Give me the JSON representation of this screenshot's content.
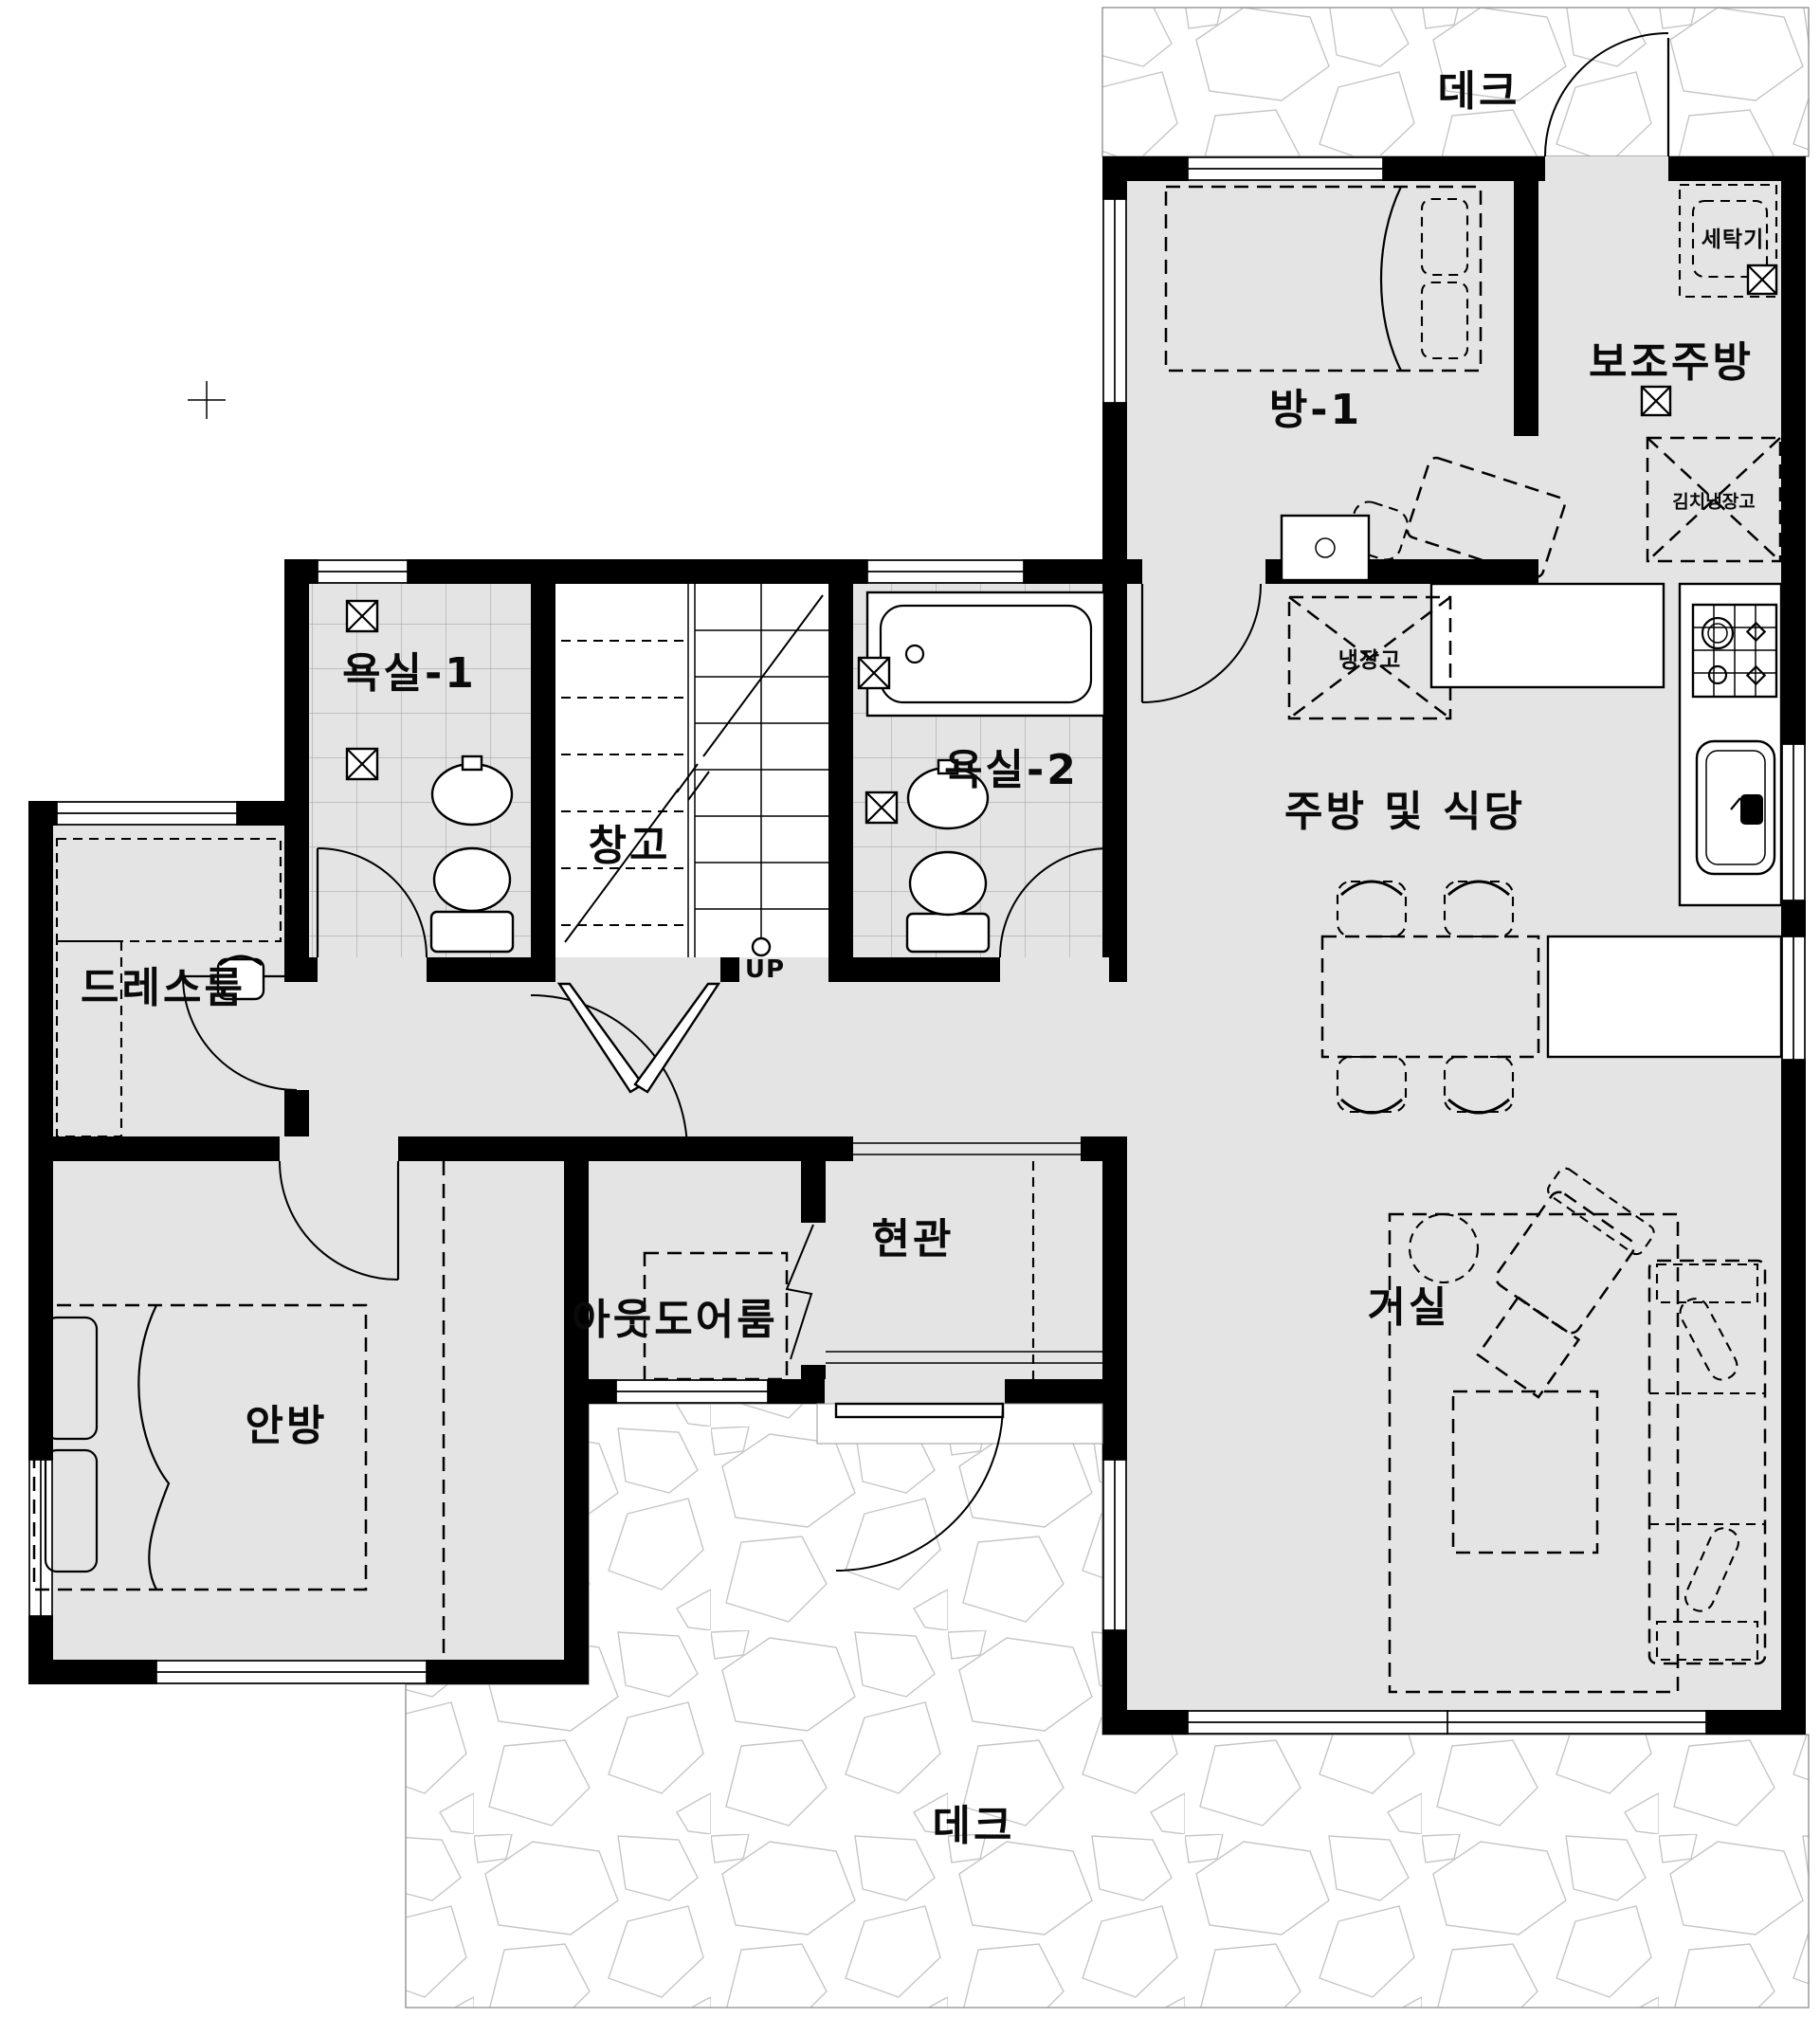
{
  "document": {
    "type": "architectural-floor-plan",
    "language": "ko"
  },
  "rooms": [
    {
      "id": "deck-top",
      "label": "데크"
    },
    {
      "id": "room-1",
      "label": "방-1"
    },
    {
      "id": "auxiliary-kitchen",
      "label": "보조주방"
    },
    {
      "id": "bathroom-1",
      "label": "욕실-1"
    },
    {
      "id": "storage",
      "label": "창고"
    },
    {
      "id": "bathroom-2",
      "label": "욕실-2"
    },
    {
      "id": "kitchen-dining",
      "label": "주방 및 식당"
    },
    {
      "id": "dress-room",
      "label": "드레스룸"
    },
    {
      "id": "entrance",
      "label": "현관"
    },
    {
      "id": "outdoor-room",
      "label": "아웃도어룸"
    },
    {
      "id": "master-bedroom",
      "label": "안방"
    },
    {
      "id": "living-room",
      "label": "거실"
    },
    {
      "id": "deck-bottom",
      "label": "데크"
    }
  ],
  "appliances": [
    {
      "id": "washing-machine",
      "label": "세탁기"
    },
    {
      "id": "kimchi-refrigerator",
      "label": "김치냉장고"
    },
    {
      "id": "refrigerator",
      "label": "냉장고"
    }
  ],
  "stairs": {
    "direction_label": "UP"
  },
  "colors": {
    "floor": "#e4e4e4",
    "wall": "#000000",
    "deck_outline": "#8a8a8a",
    "tile_line": "#a9a9a9"
  }
}
